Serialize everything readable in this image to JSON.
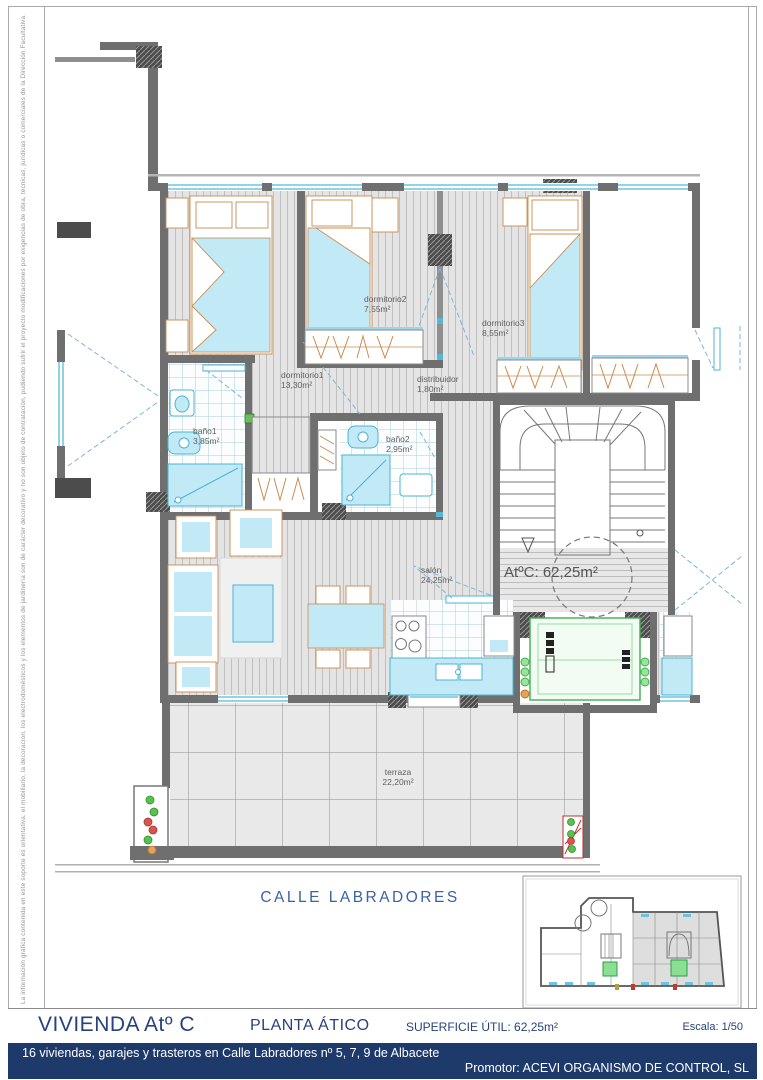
{
  "sheet": {
    "margin_note": "La información gráfica contenida en este soporte es orientativa; el mobiliario, la decoración, los electrodomésticos y los elementos de jardinería son de carácter decorativo y no son objeto de contratación, pudiendo sufrir el proyecto modificaciones por exigencias de obra, técnicas, jurídicas o comerciales de la Dirección Facultativa.",
    "street_label": "CALLE LABRADORES"
  },
  "plan": {
    "unit_label": "AtºC: 62,25m²",
    "rooms": [
      {
        "label": "dormitorio1",
        "area": "13,30m²"
      },
      {
        "label": "dormitorio2",
        "area": "7,55m²"
      },
      {
        "label": "dormitorio3",
        "area": "8,55m²"
      },
      {
        "label": "distribuidor",
        "area": "1,80m²"
      },
      {
        "label": "baño1",
        "area": "3,85m²"
      },
      {
        "label": "baño2",
        "area": "2,95m²"
      },
      {
        "label": "salón",
        "area": "24,25m²"
      },
      {
        "label": "terraza",
        "area": "22,20m²"
      }
    ]
  },
  "title_block": {
    "dwelling": "VIVIENDA Atº C",
    "plan_name": "PLANTA ÁTICO",
    "useful_area": "SUPERFICIE ÚTIL: 62,25m²",
    "scale": "Escala: 1/50",
    "project": "16 viviendas, garajes y trasteros en Calle Labradores nº 5, 7, 9 de Albacete",
    "promoter": "Promotor: ACEVI ORGANISMO DE CONTROL, SL"
  },
  "colors": {
    "navy_bar": "#1e3a6b",
    "title_text": "#26427e",
    "street_text": "#3c61a5",
    "wall_grey": "#6f6f6f",
    "fixture_cyan": "#c2eaf6",
    "fixture_cyan_stroke": "#4ab4d4",
    "furniture_orange": "#c98c52",
    "elevator_green": "#3fae52"
  }
}
